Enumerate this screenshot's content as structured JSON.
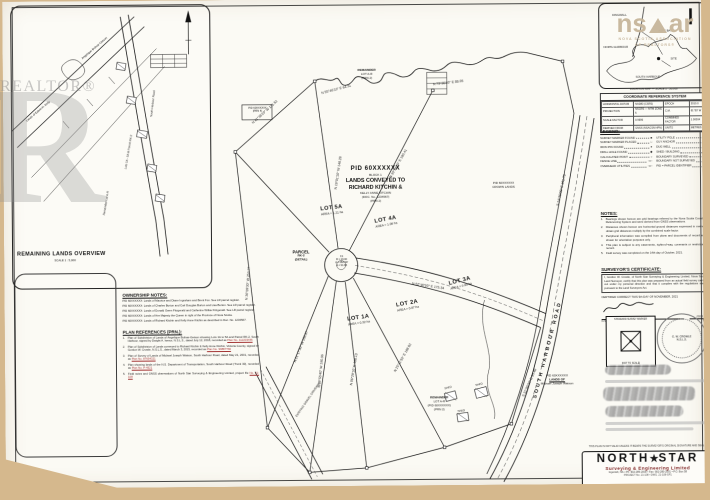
{
  "watermarks": {
    "big_letter": "R",
    "realtor": "REALTOR®",
    "nsar_left": "ns",
    "nsar_right": "ar",
    "nsar_sub1": "NOVA SCOTIA ASSOCIATION",
    "nsar_sub2": "OF REALTORS®"
  },
  "inset": {
    "title": "REMAINING LANDS OVERVIEW",
    "subtitle": "SCALE 1 : 5,000",
    "labels": [
      {
        "t": "Lands of Edwin H. Kelly",
        "x": 22,
        "y": 118,
        "r": -40
      },
      {
        "t": "Angelique Bolivar-Getson",
        "x": 78,
        "y": 56,
        "r": -40
      },
      {
        "t": "Remainder Lot A-R",
        "x": 98,
        "y": 214,
        "r": -80
      },
      {
        "t": "Lots 1A - 5A & Parcel RK-2",
        "x": 120,
        "y": 168,
        "r": -80
      },
      {
        "t": "South Harbour Road",
        "x": 146,
        "y": 116,
        "r": -83
      }
    ]
  },
  "main": {
    "block_label": [
      "PID 60XXXXXX",
      "BLOCK 1",
      "LANDS CONVEYED TO",
      "RICHARD KITCHIN &",
      "KELLY ANNE KITCHIN",
      "(DOC. No. 1234567)",
      "(PRN 2)"
    ],
    "lots": [
      {
        "label": "LOT 5A",
        "sub": "AREA = 1.21 ha",
        "x": 306,
        "y": 206,
        "r": -6
      },
      {
        "label": "LOT 4A",
        "sub": "AREA = 1.08 ha",
        "x": 360,
        "y": 218,
        "r": -10
      },
      {
        "label": "LOT 1A",
        "sub": "AREA = 0.92 ha",
        "x": 332,
        "y": 316,
        "r": -8
      },
      {
        "label": "LOT 2A",
        "sub": "AREA = 0.87 ha",
        "x": 381,
        "y": 302,
        "r": -10
      },
      {
        "label": "LOT 3A",
        "sub": "AREA = 0.95 ha",
        "x": 434,
        "y": 280,
        "r": -14
      }
    ],
    "parcel_label": [
      "PARCEL",
      "RK-2",
      "(DETAIL)"
    ],
    "remainder_top": [
      "REMAINDER",
      "LOT A-R",
      "(PRN 2)"
    ],
    "remainder_bottom": [
      "REMAINDER",
      "LOT A-R",
      "(PID 60XXXXXX)",
      "(PRN 2)"
    ],
    "culdesac": [
      "C1",
      "R = 20.00",
      "Δ = 262°40'",
      "A = 91.63"
    ],
    "pid_box": [
      "PID 60XXXXXX",
      "(PRN 4)"
    ],
    "crown_label": [
      "PID 60XXXXXX",
      "CROWN LANDS"
    ],
    "watson_label": [
      "PID 60XXXXXX",
      "LANDS OF",
      "Michael Joseph Watson"
    ],
    "road_name": "SOUTH HARBOUR ROAD",
    "driveway_label": "EXISTING GRAVEL DRIVEWAY",
    "shed_labels": [
      {
        "t": "SHED",
        "x": 439,
        "y": 389,
        "r": -12
      },
      {
        "t": "SHED",
        "x": 470,
        "y": 386,
        "r": -12
      },
      {
        "t": "SHED",
        "x": 452,
        "y": 412,
        "r": -8
      }
    ],
    "bearings": [
      {
        "t": "N 41°36'20\" W  131.52",
        "x": 248,
        "y": 122,
        "r": -42
      },
      {
        "t": "N 55°46'10\" E  64.31",
        "x": 318,
        "y": 92,
        "r": -14
      },
      {
        "t": "N 73°30'40\" E  88.05",
        "x": 430,
        "y": 84,
        "r": -6
      },
      {
        "t": "N 36°09'30\" W  252.77",
        "x": 240,
        "y": 300,
        "r": -85
      },
      {
        "t": "N 52°40'50\" E  175.34",
        "x": 408,
        "y": 283,
        "r": 9
      },
      {
        "t": "N 16°01'10\" W  148.28",
        "x": 330,
        "y": 190,
        "r": -81
      },
      {
        "t": "N 30°54'20\" E  190.41",
        "x": 385,
        "y": 178,
        "r": -60
      },
      {
        "t": "N 21°17'30\" W  158.87",
        "x": 288,
        "y": 362,
        "r": -68
      },
      {
        "t": "N 08°55'40\" W  190.06",
        "x": 312,
        "y": 388,
        "r": -84
      },
      {
        "t": "N 06°29'10\" E  186.13",
        "x": 344,
        "y": 386,
        "r": -80
      },
      {
        "t": "N 25°11'50\" E  188.92",
        "x": 388,
        "y": 372,
        "r": -60
      },
      {
        "t": "S 24°30'00\" E  101.73",
        "x": 552,
        "y": 208,
        "r": -77
      },
      {
        "t": "S 31°05'30\" E  95.40",
        "x": 516,
        "y": 398,
        "r": -65
      }
    ]
  },
  "rc": {
    "map_caption": "LOCATION MAP — SCALE 1 : 50,000",
    "map_labels": [
      {
        "t": "DINGWALL",
        "x": 610,
        "y": 16
      },
      {
        "t": "ASPY BAY",
        "x": 656,
        "y": 32
      },
      {
        "t": "NORTH HARBOUR",
        "x": 601,
        "y": 48
      },
      {
        "t": "SITE",
        "x": 668,
        "y": 60
      },
      {
        "t": "SOUTH HARBOUR",
        "x": 633,
        "y": 78
      }
    ],
    "crs_title": "COORDINATE REFERENCE SYSTEM",
    "crs_rows": [
      [
        "HORIZONTAL DATUM",
        "NAD83 (CSRS)",
        "EPOCH",
        "2010.0"
      ],
      [
        "PROJECTION",
        "NSCRS — MTM ZONE 5",
        "C.M.",
        "61°30' W"
      ],
      [
        "SCALE FACTOR",
        "0.9999",
        "COMBINED FACTOR",
        "1.00004"
      ],
      [
        "DERIVED FROM",
        "GNSS (NSACSN HPN)",
        "UNITS",
        "METRES"
      ]
    ],
    "legend_title": "LEGEND:",
    "legend_col1": [
      {
        "label": "SURVEY MARKER FOUND",
        "sym": "■"
      },
      {
        "label": "SURVEY MARKER PLACED",
        "sym": "□"
      },
      {
        "label": "IRON PIN FOUND",
        "sym": "●"
      },
      {
        "label": "DRILL HOLE FOUND",
        "sym": "◆"
      },
      {
        "label": "CALCULATED POINT",
        "sym": "○"
      },
      {
        "label": "FENCE LINE",
        "sym": "–x–"
      },
      {
        "label": "OVERHEAD UTILITIES",
        "sym": "–o–"
      }
    ],
    "legend_col2": [
      {
        "label": "UTILITY POLE",
        "sym": "⊙"
      },
      {
        "label": "GUY ANCHOR",
        "sym": "↙"
      },
      {
        "label": "DUG WELL",
        "sym": "◉"
      },
      {
        "label": "SHED / BUILDING",
        "sym": "▭"
      },
      {
        "label": "BOUNDARY SURVEYED",
        "sym": "——"
      },
      {
        "label": "BOUNDARY NOT SURVEYED",
        "sym": "- - -"
      },
      {
        "label": "PID = PARCEL IDENTIFIER",
        "sym": ""
      }
    ],
    "notes_title": "NOTES:",
    "notes": [
      {
        "n": "1.",
        "text": "Bearings shown hereon are grid bearings referred to the Nova Scotia Coordinate Referencing System and were derived from GNSS observations."
      },
      {
        "n": "2.",
        "text": "Distances shown hereon are horizontal ground distances expressed in metres; to obtain grid distances multiply by the combined scale factor."
      },
      {
        "n": "3.",
        "text": "Peripheral information was compiled from plans and documents of record and is shown for orientation purposes only."
      },
      {
        "n": "4.",
        "text": "This plan is subject to any easements, rights-of-way, covenants or restrictions of record."
      },
      {
        "n": "5.",
        "text": "Field survey was completed on the 14th day of October, 2021."
      }
    ],
    "cert_title": "SURVEYOR'S CERTIFICATE:",
    "cert_body": "I, Gordon W. Crowle, of North Star Surveying & Engineering Limited, Nova Scotia Land Surveyor, certify that this plan was prepared from an actual field survey carried out under my personal direction and that it complies with the regulations made pursuant to the Land Surveyors Act.",
    "cert_line": "CERTIFIED CORRECT THIS 9th DAY OF NOVEMBER, 2021",
    "cert_year": "2021",
    "cert_nsls": "N.S.L.S.",
    "cert_date": "DATE",
    "stamp_top": "STANDARD SURVEY MARKER",
    "stamp_bottom": "(NOT TO SCALE)",
    "seal_line1": "G. W. CROWLE",
    "seal_line2": "N.S.L.S.",
    "pre_title_note": "THIS PLAN IS NOT VALID UNLESS IT BEARS THE SURVEYOR'S ORIGINAL SIGNATURE AND SEAL",
    "title_block": {
      "name1": "NORTH",
      "star": "★",
      "name2": "STAR",
      "tagline": "Surveying & Engineering Limited",
      "contact": "Ingonish, NS  •  Ph: 902-285-2000  •  Fax: 902-285-2001  •  P.O. Box 58",
      "dwg": "PROJECT No. 21-108  •  DWG. 21-108-SP1"
    }
  },
  "left_notes": {
    "ownership_title": "OWNERSHIP NOTES:",
    "ownership": [
      "PID 60XXXXXX: Lands of Maurice and Diane Ingraham and Brent Fox. See LR parcel register.",
      "PID 60XXXXXX: Lands of Charles Burton and Carl Douglas Burton and Lisa Burton. See LR parcel register.",
      "PID 60XXXXXX: Lands of Donald Owen Fitzgerald and Catherine Wilkie Fitzgerald. See LR parcel register.",
      "PID 60XXXXXX: Lands of Her Majesty the Queen in right of the Province of Nova Scotia.",
      "PID 60XXXXXX: Lands of Richard Kitchin and Kelly Anne Kitchin as described in Doc. No. 1234567."
    ],
    "plan_refs_title": "PLAN REFERENCES (PRN.):",
    "plan_refs": [
      {
        "n": "1.",
        "text": "Plan of Subdivision of Lands of Angelique Bolivar-Getson showing Lots 1A to 5A and Parcel RK-2, South Harbour, signed by Dwight A. Isenor, N.S.L.S., dated July 12, 2018, recorded as ",
        "ref": "Plan No. 112233445"
      },
      {
        "n": "2.",
        "text": "Plan of Subdivision of Lands conveyed to Richard Kitchin & Kelly Anne Kitchin, Victoria County, signed by Gordon W. Crowle, N.S.L.S., dated March 3, 2015, recorded as ",
        "ref": "Plan No. 99887766"
      },
      {
        "n": "3.",
        "text": "Plan of Survey of Lands of Michael Joseph Watson, South Harbour Road, dated May 21, 2001, recorded as ",
        "ref": "Plan No. 87654321"
      },
      {
        "n": "4.",
        "text": "Plan showing lands of the N.S. Department of Transportation, South Harbour Road (Trunk 30), recorded as ",
        "ref": "Plan No. P-4521"
      },
      {
        "n": "5.",
        "text": "Field notes and GNSS observations of North Star Surveying & Engineering Limited, project file ",
        "ref": "No. 21-108"
      }
    ]
  }
}
